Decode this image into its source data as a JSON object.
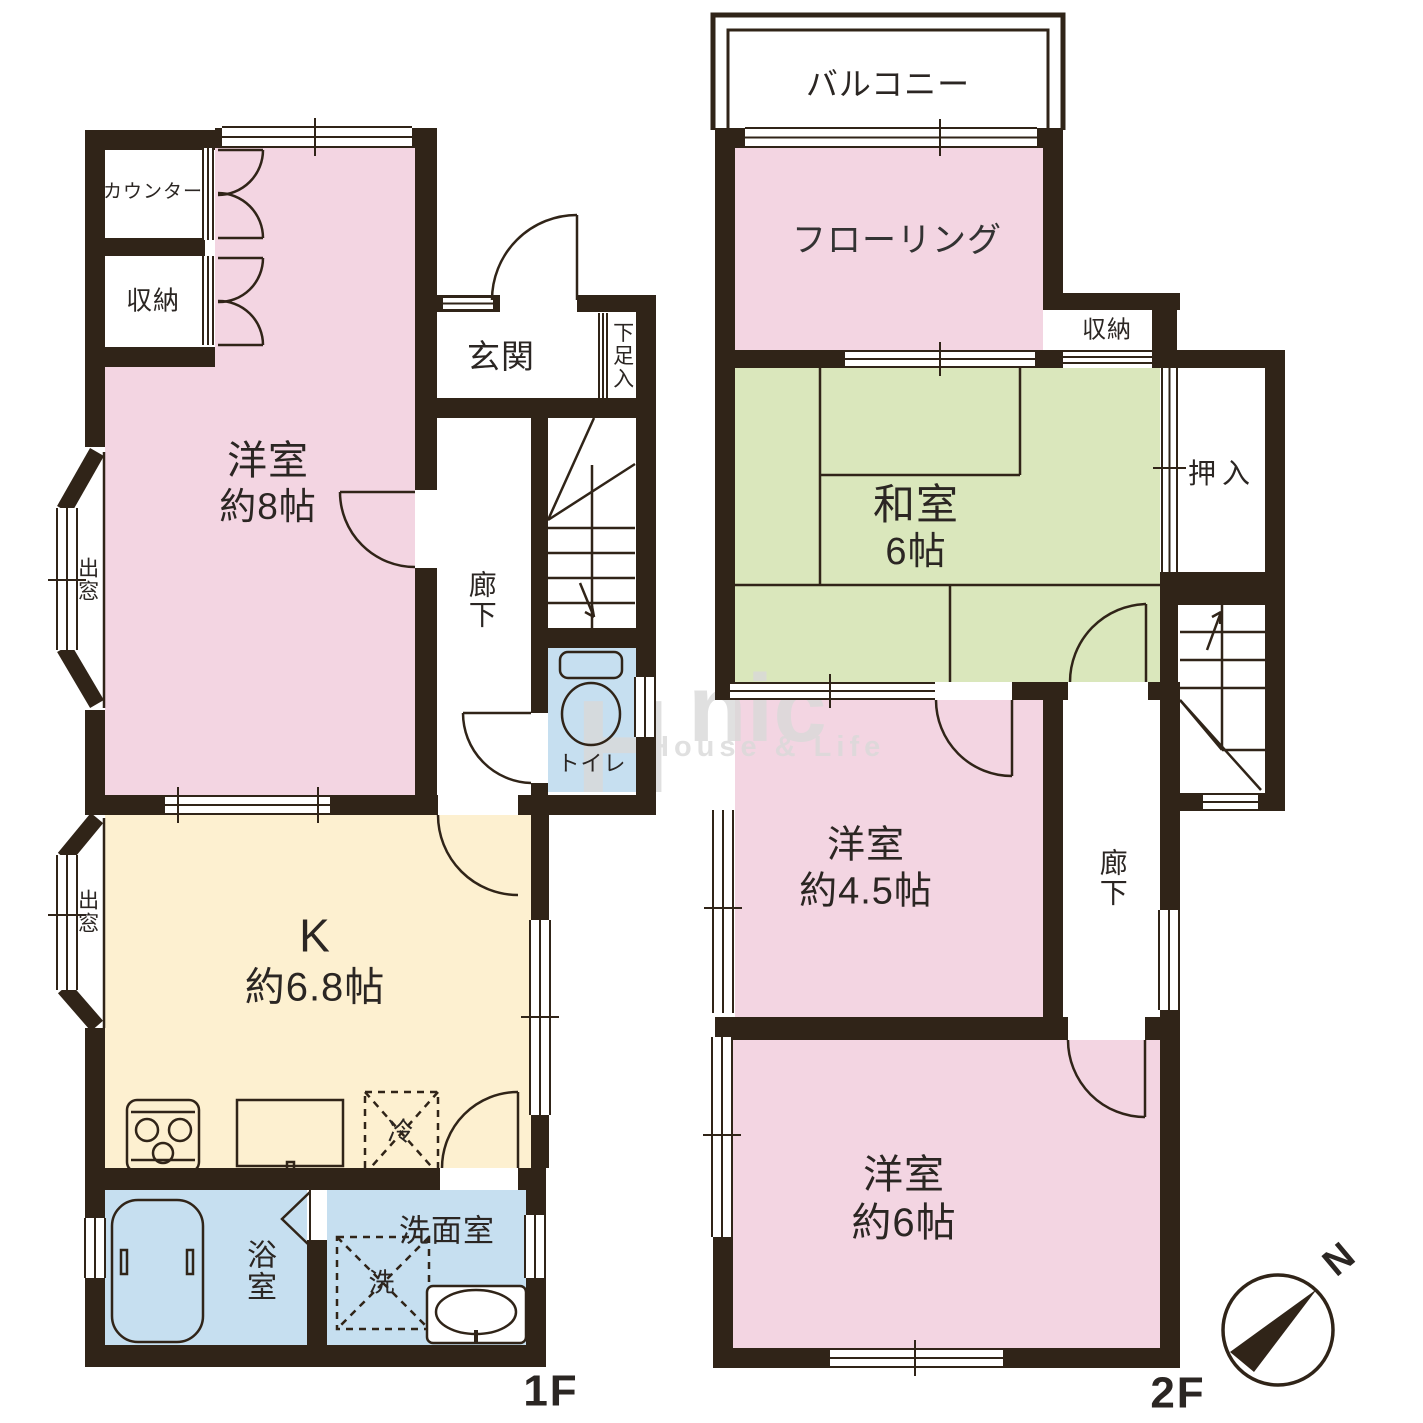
{
  "floors": {
    "f1": {
      "floor_label": "1F",
      "counter": "カウンター",
      "storage": "収納",
      "western8": {
        "l1": "洋室",
        "l2": "約8帖"
      },
      "genkan": "玄関",
      "shoe": "下足入",
      "corridor": "廊下",
      "toilet": "トイレ",
      "kitchen": {
        "l1": "K",
        "l2": "約6.8帖"
      },
      "bay_upper": "出窓",
      "bay_lower": "出窓",
      "bath": "浴室",
      "washroom": "洗面室",
      "fridge": "冷",
      "washer": "洗"
    },
    "f2": {
      "floor_label": "2F",
      "balcony": "バルコニー",
      "flooring": "フローリング",
      "storage": "収納",
      "washitsu": {
        "l1": "和室",
        "l2": "6帖"
      },
      "oshiire": "押入",
      "corridor": "廊下",
      "western45": {
        "l1": "洋室",
        "l2": "約4.5帖"
      },
      "western6": {
        "l1": "洋室",
        "l2": "約6帖"
      }
    }
  },
  "compass": {
    "north": "N"
  },
  "watermark": {
    "mark": "H",
    "brand": "nic",
    "tagline": "House & Life"
  },
  "colors": {
    "wall": "#302418",
    "pink": "#f3d5e2",
    "green": "#dae7bc",
    "cream": "#fdf0d0",
    "blue": "#c6dff0",
    "line": "#302418",
    "label": "#2b2623",
    "watermark": "#d9d9d9"
  }
}
